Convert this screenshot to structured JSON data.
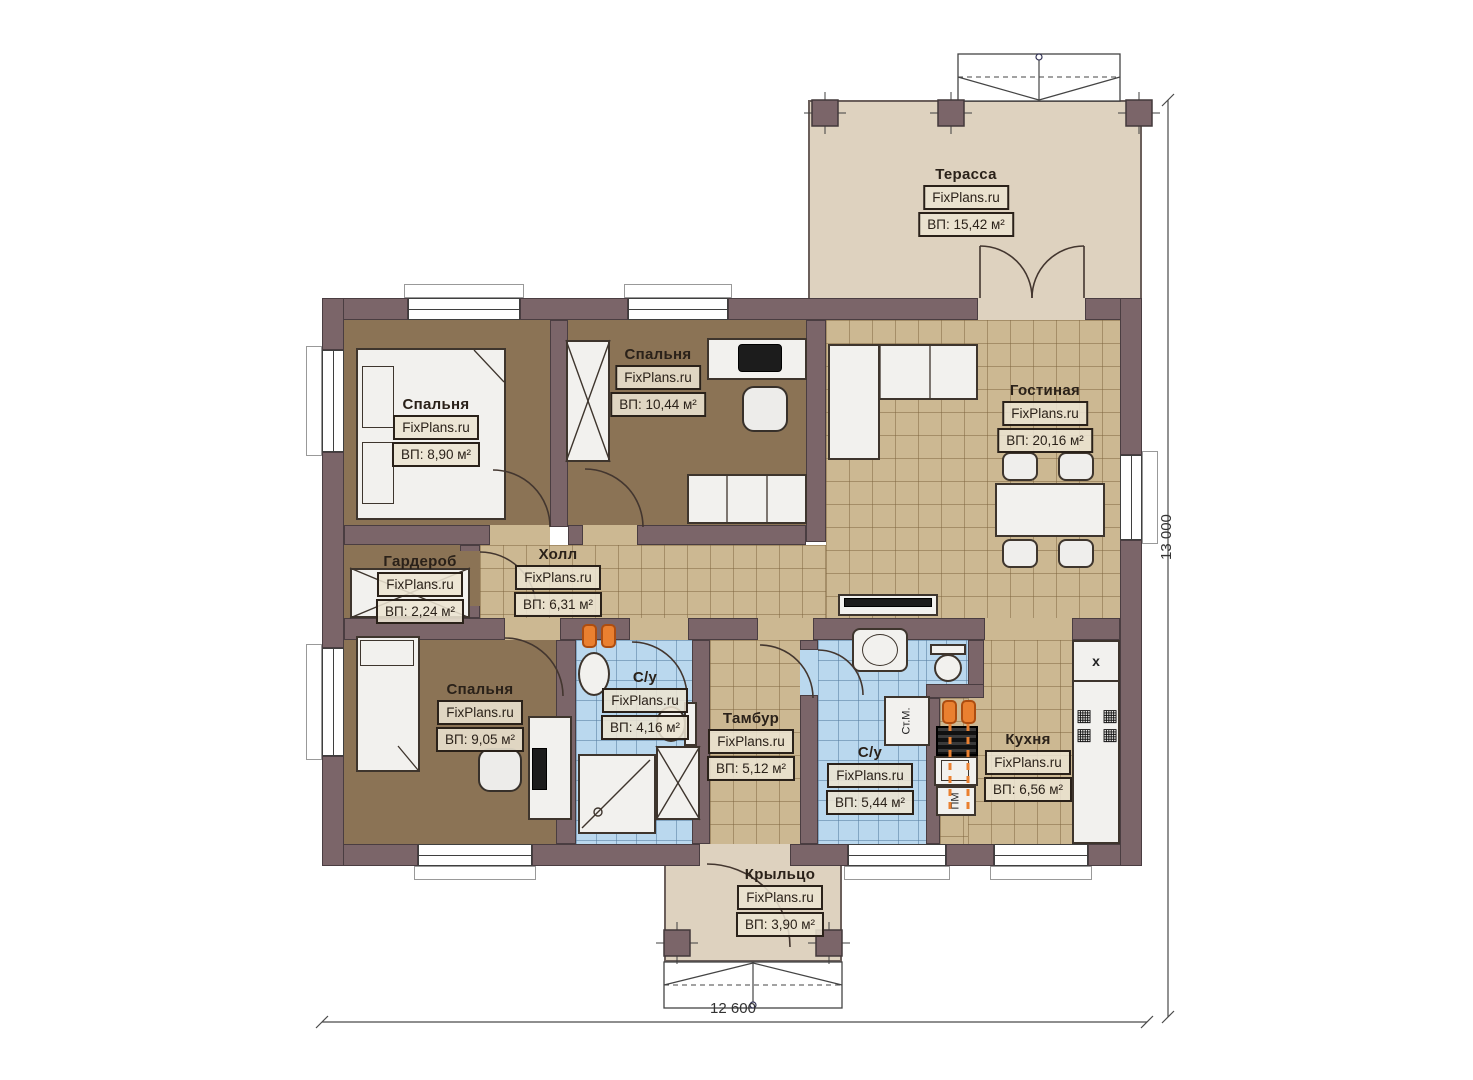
{
  "rooms": [
    {
      "key": "terrace",
      "name": "Терасса",
      "brand": "FixPlans.ru",
      "area": "ВП: 15,42 м²"
    },
    {
      "key": "bedroom-1",
      "name": "Спальня",
      "brand": "FixPlans.ru",
      "area": "ВП: 8,90 м²"
    },
    {
      "key": "bedroom-2",
      "name": "Спальня",
      "brand": "FixPlans.ru",
      "area": "ВП: 10,44 м²"
    },
    {
      "key": "living",
      "name": "Гостиная",
      "brand": "FixPlans.ru",
      "area": "ВП: 20,16 м²"
    },
    {
      "key": "wardrobe",
      "name": "Гардероб",
      "brand": "FixPlans.ru",
      "area": "ВП: 2,24 м²"
    },
    {
      "key": "hall",
      "name": "Холл",
      "brand": "FixPlans.ru",
      "area": "ВП: 6,31 м²"
    },
    {
      "key": "bedroom-3",
      "name": "Спальня",
      "brand": "FixPlans.ru",
      "area": "ВП: 9,05 м²"
    },
    {
      "key": "bathroom-1",
      "name": "С/у",
      "brand": "FixPlans.ru",
      "area": "ВП: 4,16 м²"
    },
    {
      "key": "vestibule",
      "name": "Тамбур",
      "brand": "FixPlans.ru",
      "area": "ВП: 5,12 м²"
    },
    {
      "key": "bathroom-2",
      "name": "С/у",
      "brand": "FixPlans.ru",
      "area": "ВП: 5,44 м²"
    },
    {
      "key": "kitchen",
      "name": "Кухня",
      "brand": "FixPlans.ru",
      "area": "ВП: 6,56 м²"
    },
    {
      "key": "porch",
      "name": "Крыльцо",
      "brand": "FixPlans.ru",
      "area": "ВП: 3,90 м²"
    }
  ],
  "dimensions": {
    "width": "12 600",
    "height": "13 000"
  },
  "appliances": {
    "washing_machine": "Ст.М.",
    "dishwasher": "ПМ",
    "sink_mark": "x"
  },
  "colors": {
    "wall": "#7B6569",
    "wood_floor": "#8B7355",
    "tile_floor": "#CCB892",
    "bath_tile": "#BAD8EE",
    "outdoor": "#DED2BF",
    "radiator": "#EA8030"
  }
}
